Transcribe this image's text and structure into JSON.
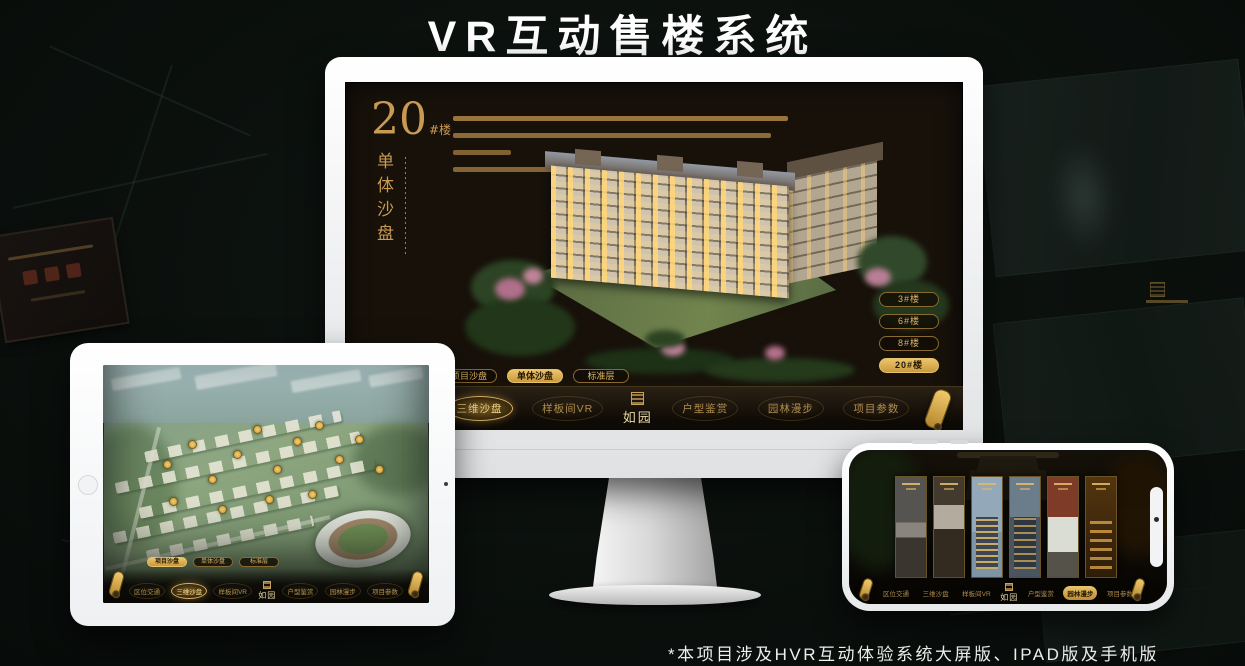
{
  "page": {
    "title": "VR互动售楼系统",
    "footnote": "*本项目涉及HVR互动体验系统大屏版、IPAD版及手机版"
  },
  "colors": {
    "gold": "#c9a158",
    "gold_bright": "#ecc469",
    "screen_bg": "#17110a",
    "canvas_bg": "#0b100d",
    "selected_text": "#241703",
    "white": "#ffffff"
  },
  "monitor": {
    "unit": {
      "number": "20",
      "suffix": "#楼",
      "title_vertical": "单体沙盘"
    },
    "floor_buttons": [
      {
        "label": "3#楼",
        "selected": false
      },
      {
        "label": "6#楼",
        "selected": false
      },
      {
        "label": "8#楼",
        "selected": false
      },
      {
        "label": "20#楼",
        "selected": true
      }
    ],
    "sub_tabs": [
      {
        "label": "项目沙盘",
        "selected": false
      },
      {
        "label": "单体沙盘",
        "selected": true
      },
      {
        "label": "标准层",
        "selected": false
      }
    ],
    "nav": {
      "logo": "如园",
      "items": [
        {
          "label": "区位交通",
          "selected": false
        },
        {
          "label": "三维沙盘",
          "selected": true
        },
        {
          "label": "样板间VR",
          "selected": false
        },
        {
          "label": "户型鉴赏",
          "selected": false
        },
        {
          "label": "园林漫步",
          "selected": false
        },
        {
          "label": "项目参数",
          "selected": false
        }
      ]
    }
  },
  "tablet": {
    "sub_tabs": [
      {
        "label": "项目沙盘",
        "selected": true
      },
      {
        "label": "单体沙盘",
        "selected": false
      },
      {
        "label": "标准层",
        "selected": false
      }
    ],
    "nav": {
      "logo": "如园",
      "items": [
        {
          "label": "区位交通",
          "selected": false
        },
        {
          "label": "三维沙盘",
          "selected": true
        },
        {
          "label": "样板间VR",
          "selected": false
        },
        {
          "label": "户型鉴赏",
          "selected": false
        },
        {
          "label": "园林漫步",
          "selected": false
        },
        {
          "label": "项目参数",
          "selected": false
        }
      ]
    }
  },
  "phone": {
    "nav": {
      "logo": "如园",
      "items": [
        {
          "label": "区位交通",
          "selected": false
        },
        {
          "label": "三维沙盘",
          "selected": false
        },
        {
          "label": "样板间VR",
          "selected": false
        },
        {
          "label": "户型鉴赏",
          "selected": false
        },
        {
          "label": "园林漫步",
          "selected": true
        },
        {
          "label": "项目参数",
          "selected": false
        }
      ]
    }
  }
}
